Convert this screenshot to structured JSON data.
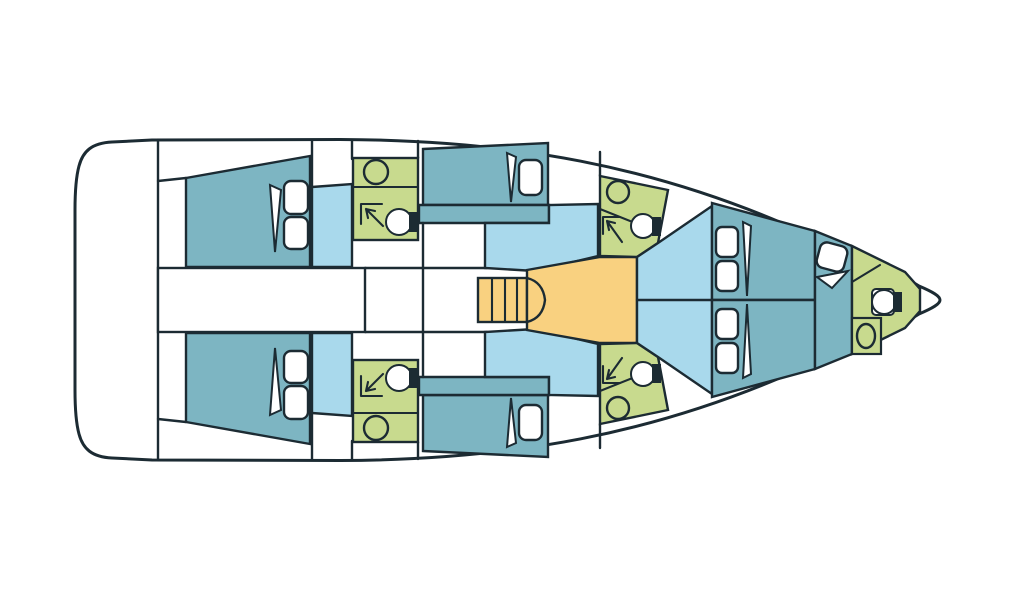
{
  "meta": {
    "title": "Sailing yacht deck plan — top view, bow to the right"
  },
  "colors": {
    "background": "#ffffff",
    "outline": "#1c2b33",
    "hull": "#ffffff",
    "cabin": "#7db5c2",
    "seating": "#a9d9ec",
    "bathroom": "#c8da8e",
    "galley": "#f9d180",
    "fixture_fill": "#ffffff",
    "tank": "#1c2b33"
  },
  "regions": {
    "swim_platform": {
      "kind": "deck"
    },
    "engine_compartment": {
      "kind": "hatch"
    },
    "corridor": {
      "kind": "walkway"
    },
    "companionway": {
      "kind": "stairs",
      "treads": 4
    },
    "galley": {
      "kind": "galley"
    },
    "aft_cabin_port": {
      "kind": "cabin",
      "pillows": 2,
      "icons": [
        "pillow-icon",
        "blanket-fold-icon"
      ]
    },
    "aft_cabin_starboard": {
      "kind": "cabin",
      "pillows": 2,
      "icons": [
        "pillow-icon",
        "blanket-fold-icon"
      ]
    },
    "head_aft_port": {
      "kind": "bathroom",
      "icons": [
        "sink-icon",
        "shower-icon",
        "toilet-icon"
      ]
    },
    "head_aft_starboard": {
      "kind": "bathroom",
      "icons": [
        "sink-icon",
        "shower-icon",
        "toilet-icon"
      ]
    },
    "mid_cabin_port": {
      "kind": "cabin",
      "pillows": 1,
      "icons": [
        "pillow-icon",
        "blanket-fold-icon"
      ]
    },
    "mid_cabin_starboard": {
      "kind": "cabin",
      "pillows": 1,
      "icons": [
        "pillow-icon",
        "blanket-fold-icon"
      ]
    },
    "settee_port": {
      "kind": "seating"
    },
    "settee_starboard": {
      "kind": "seating"
    },
    "head_forward_port": {
      "kind": "bathroom",
      "icons": [
        "sink-icon",
        "shower-icon",
        "toilet-icon"
      ]
    },
    "head_forward_starboard": {
      "kind": "bathroom",
      "icons": [
        "sink-icon",
        "shower-icon",
        "toilet-icon"
      ]
    },
    "forward_cabin_port_bed": {
      "kind": "berth",
      "pillows": 2
    },
    "forward_cabin_starboard_bed": {
      "kind": "berth",
      "pillows": 2
    },
    "bow_berth": {
      "kind": "berth",
      "pillows": 1
    },
    "head_bow": {
      "kind": "bathroom",
      "icons": [
        "toilet-icon",
        "sink-icon"
      ]
    }
  }
}
